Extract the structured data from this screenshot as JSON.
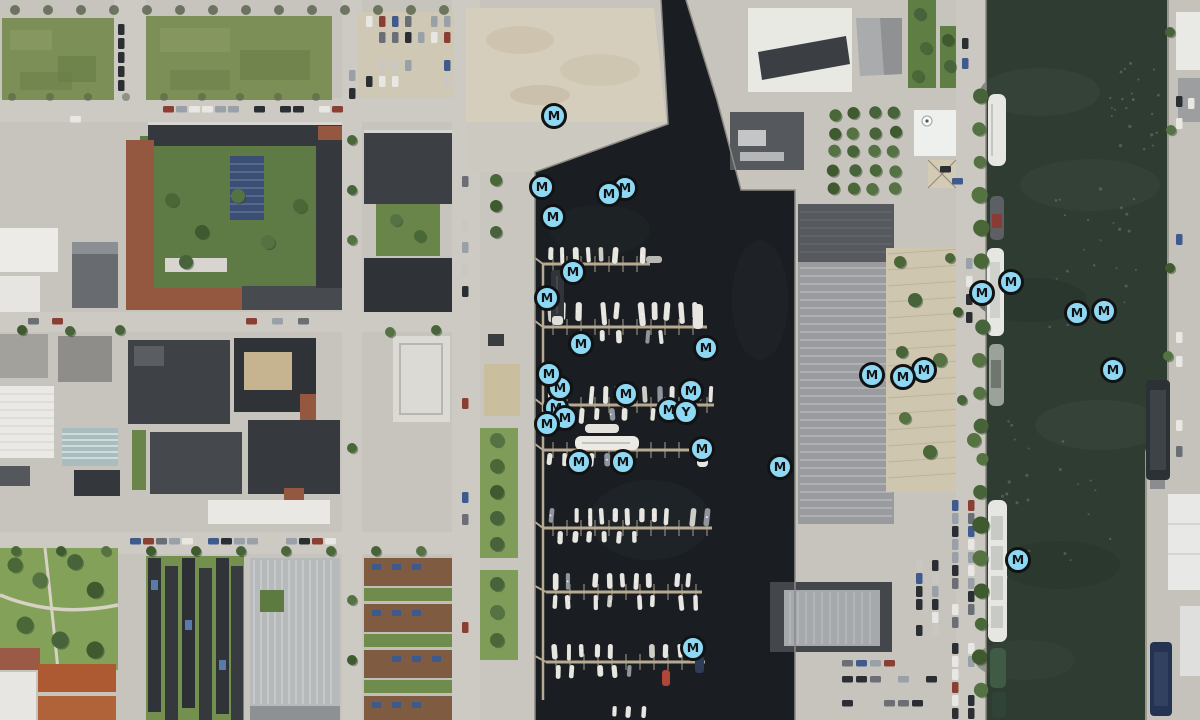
{
  "map": {
    "view": "satellite-aerial",
    "scene": "harbor-marina-with-city-blocks-warehouse-pier-and-canal",
    "width_px": 1200,
    "height_px": 720,
    "palette": {
      "marina_water": "#1A1E22",
      "canal_water": "#2F3C32",
      "land_pavement": "#C7C4BD",
      "grass": "#7C8F57",
      "sand_lot": "#D6CEBC",
      "warehouse_roof": "#999B9E",
      "red_roof": "#94573F",
      "dock": "#B6AA92"
    },
    "marker_style": {
      "shape": "circle",
      "fill": "#8ED8F3",
      "ring": "#101214",
      "glyph_color": "#101214",
      "diameter_px": 27
    },
    "markers": [
      {
        "label": "M",
        "x": 554,
        "y": 116
      },
      {
        "label": "M",
        "x": 542,
        "y": 187
      },
      {
        "label": "M",
        "x": 625,
        "y": 188
      },
      {
        "label": "M",
        "x": 609,
        "y": 194
      },
      {
        "label": "M",
        "x": 553,
        "y": 217
      },
      {
        "label": "M",
        "x": 573,
        "y": 272
      },
      {
        "label": "M",
        "x": 547,
        "y": 298
      },
      {
        "label": "M",
        "x": 581,
        "y": 344
      },
      {
        "label": "M",
        "x": 706,
        "y": 348
      },
      {
        "label": "M",
        "x": 691,
        "y": 391
      },
      {
        "label": "M",
        "x": 626,
        "y": 394
      },
      {
        "label": "M",
        "x": 556,
        "y": 408
      },
      {
        "label": "M",
        "x": 565,
        "y": 418
      },
      {
        "label": "M",
        "x": 547,
        "y": 424
      },
      {
        "label": "M",
        "x": 560,
        "y": 388
      },
      {
        "label": "M",
        "x": 549,
        "y": 374
      },
      {
        "label": "M",
        "x": 669,
        "y": 410
      },
      {
        "label": "Y",
        "x": 686,
        "y": 412
      },
      {
        "label": "M",
        "x": 702,
        "y": 449
      },
      {
        "label": "M",
        "x": 579,
        "y": 462
      },
      {
        "label": "M",
        "x": 623,
        "y": 462
      },
      {
        "label": "M",
        "x": 780,
        "y": 467
      },
      {
        "label": "M",
        "x": 872,
        "y": 375
      },
      {
        "label": "M",
        "x": 924,
        "y": 370
      },
      {
        "label": "M",
        "x": 903,
        "y": 377
      },
      {
        "label": "M",
        "x": 982,
        "y": 293
      },
      {
        "label": "M",
        "x": 1011,
        "y": 282
      },
      {
        "label": "M",
        "x": 1077,
        "y": 313
      },
      {
        "label": "M",
        "x": 1104,
        "y": 311
      },
      {
        "label": "M",
        "x": 1113,
        "y": 370
      },
      {
        "label": "M",
        "x": 1018,
        "y": 560
      },
      {
        "label": "M",
        "x": 693,
        "y": 648
      }
    ]
  }
}
